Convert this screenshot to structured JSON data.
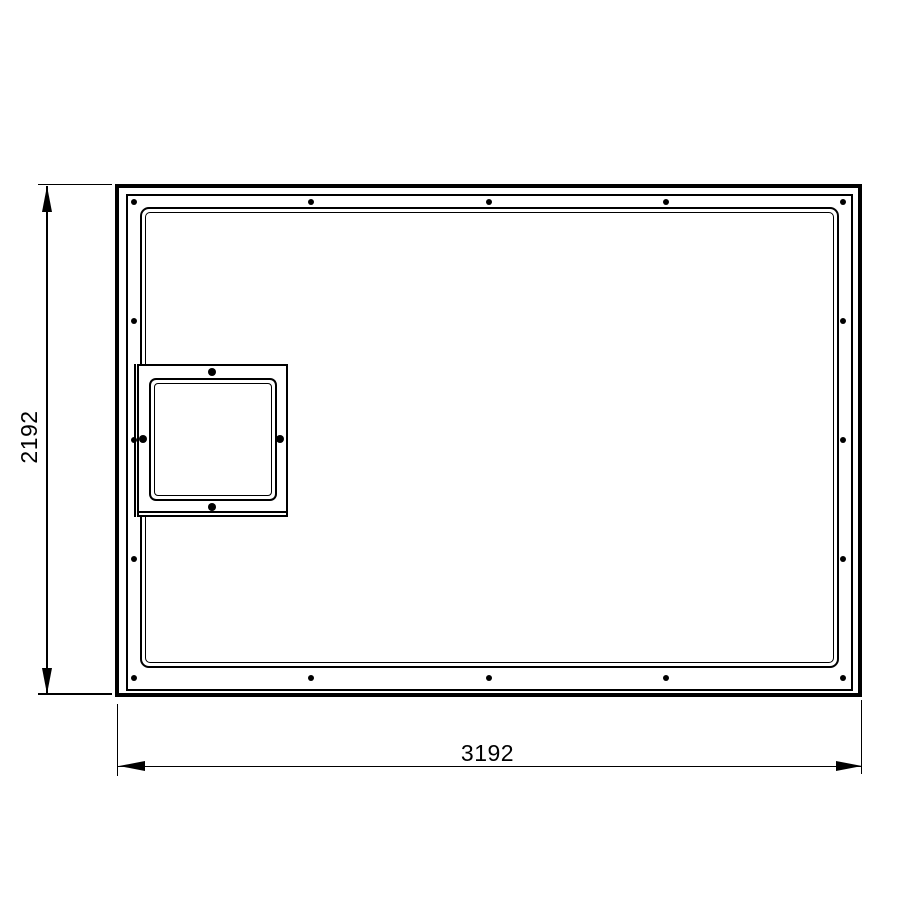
{
  "meta": {
    "type": "technical-drawing",
    "subject": "rectangular frame with inner opening and square access panel, front view"
  },
  "palette": {
    "line": "#000000",
    "background": "#ffffff"
  },
  "dimensions": {
    "height": {
      "value": "2192",
      "orientation": "vertical",
      "position": "left"
    },
    "width": {
      "value": "3192",
      "orientation": "horizontal",
      "position": "bottom"
    }
  },
  "screws": {
    "frame": {
      "diameter": 6,
      "points": [
        {
          "x": 134,
          "y": 201.5
        },
        {
          "x": 311.3,
          "y": 201.5
        },
        {
          "x": 488.5,
          "y": 201.5
        },
        {
          "x": 665.8,
          "y": 201.5
        },
        {
          "x": 843.3,
          "y": 201.5
        },
        {
          "x": 134,
          "y": 321
        },
        {
          "x": 843.3,
          "y": 321
        },
        {
          "x": 134,
          "y": 440
        },
        {
          "x": 843.3,
          "y": 440
        },
        {
          "x": 134,
          "y": 558.5
        },
        {
          "x": 843.3,
          "y": 558.5
        },
        {
          "x": 134,
          "y": 678
        },
        {
          "x": 311.3,
          "y": 678
        },
        {
          "x": 488.5,
          "y": 678
        },
        {
          "x": 665.8,
          "y": 678
        },
        {
          "x": 843.3,
          "y": 678
        }
      ]
    },
    "panel": {
      "diameter": 8,
      "points": [
        {
          "x": 212,
          "y": 371.5
        },
        {
          "x": 142.5,
          "y": 439
        },
        {
          "x": 280,
          "y": 439
        },
        {
          "x": 211.5,
          "y": 506.5
        }
      ]
    }
  }
}
